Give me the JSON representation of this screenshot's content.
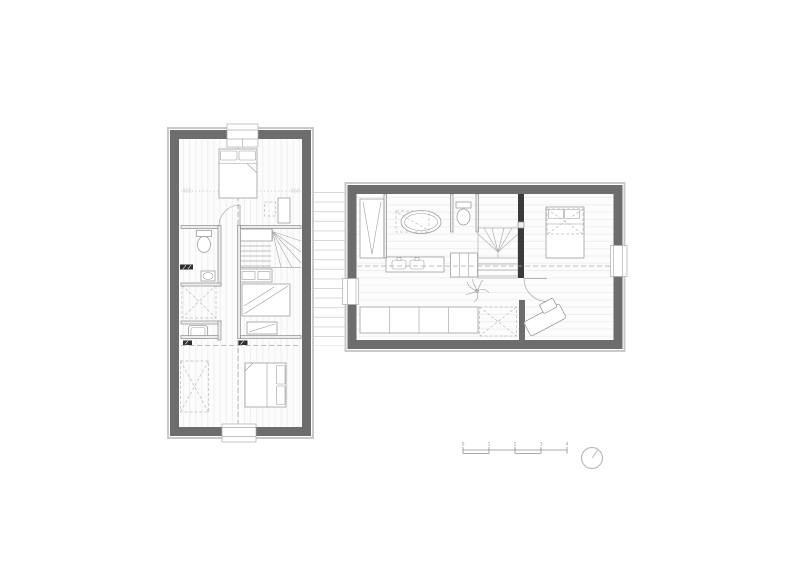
{
  "page": {
    "background": "#ffffff",
    "kind": "architectural floor plan, upper level, two volumes linked by a deck"
  },
  "colors": {
    "wall": "#6d6d6d",
    "band": "#c9c9c9",
    "dark": "#3a3a3a",
    "furn": "#9e9e9e",
    "dash": "#a6a6a6",
    "floor": "#fcfcfc",
    "floorline": "#efefef",
    "deckline": "#d7d7d7",
    "ink": "#8f8f8f"
  },
  "scale_bar": {
    "labels": [
      "0",
      "1",
      "2",
      "3",
      "4"
    ]
  },
  "symbols": [
    "double-bed",
    "single-bed",
    "pillow",
    "toilet",
    "washbasin",
    "bathtub",
    "shower-tray",
    "vanity-double-sink",
    "wardrobe",
    "staircase-winder",
    "radiator",
    "skylight-dashed-cross",
    "sideboard",
    "plant",
    "chaise",
    "door-swing",
    "deck-boards",
    "scale-bar",
    "north-arrow"
  ]
}
